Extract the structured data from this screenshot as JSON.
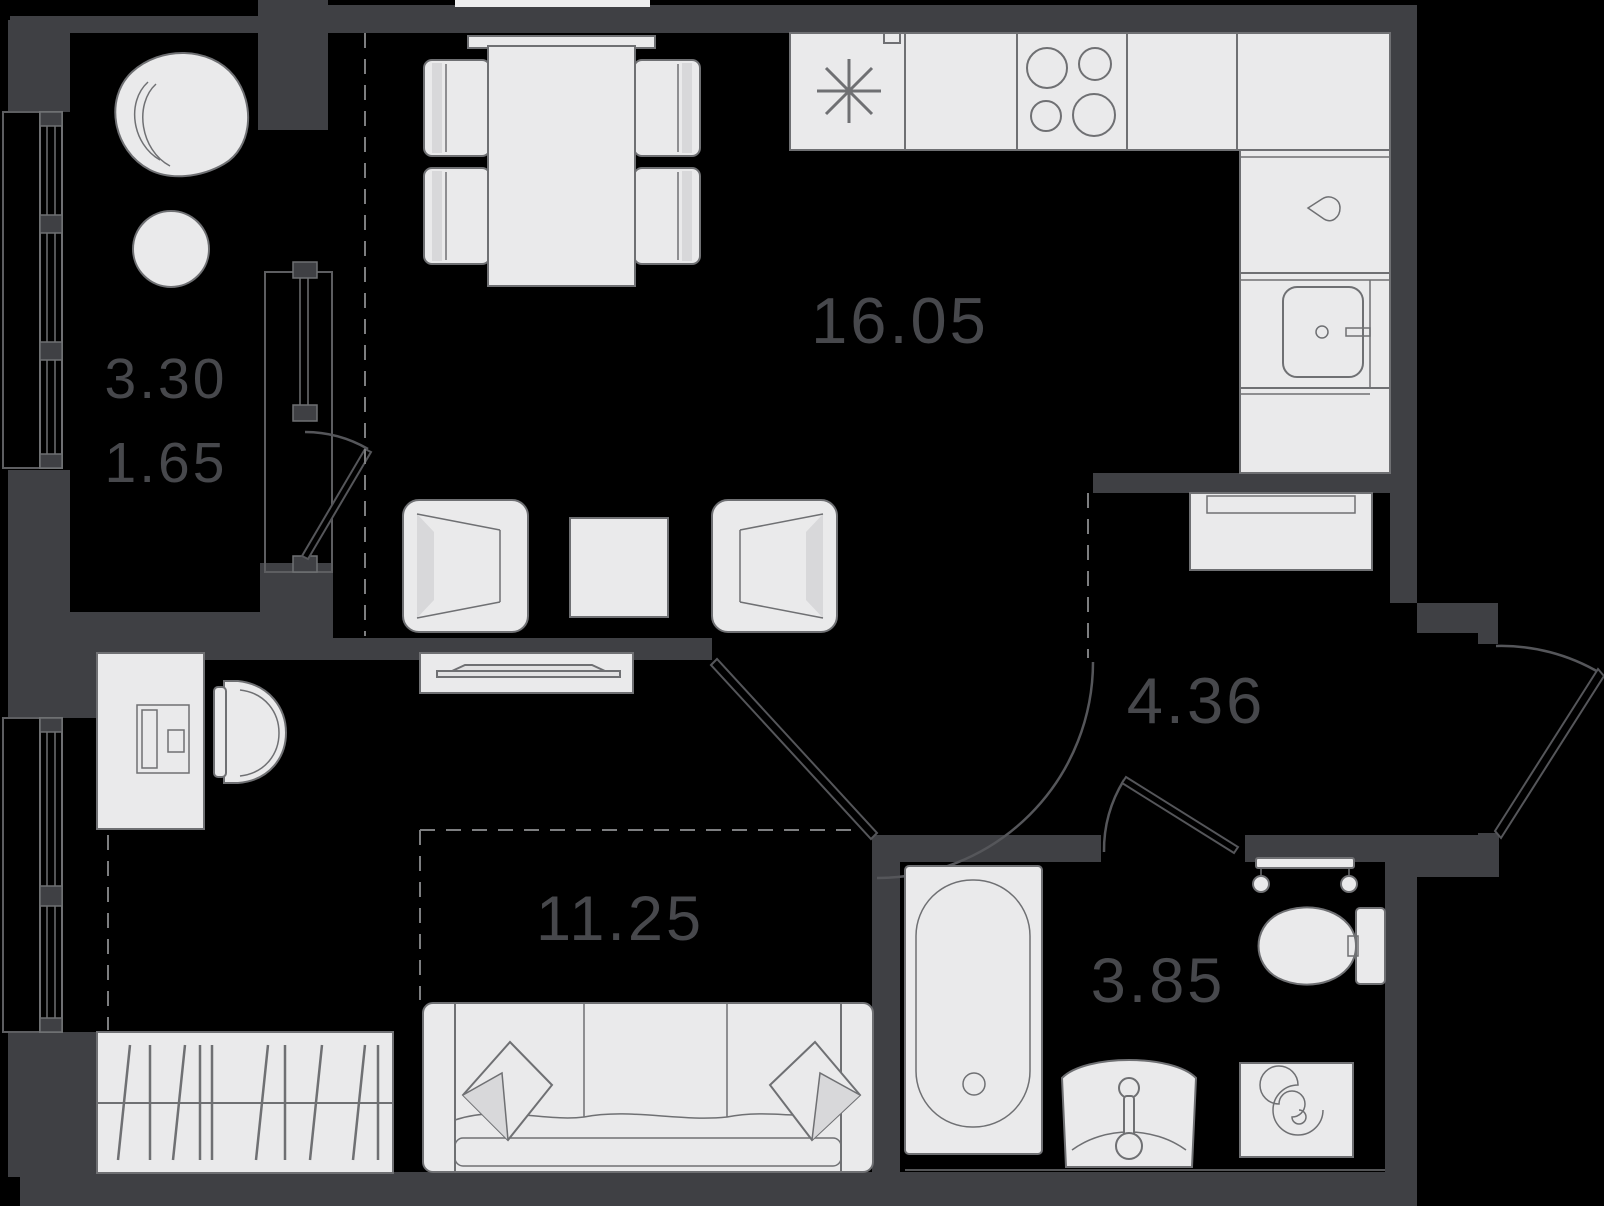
{
  "plan": {
    "title": "One-room apartment floor plan",
    "colors": {
      "background": "#000000",
      "walls": "#3f4044",
      "furniture_fill": "#eaeaeb",
      "furniture_stroke": "#6f7073",
      "label_text": "#47484c",
      "dashed_zone_line": "#7d7e80"
    },
    "rooms": [
      {
        "name": "balcony",
        "label_primary": "3.30",
        "label_secondary": "1.65",
        "furniture": [
          "lounge-chair",
          "round-table",
          "panoramic-window"
        ]
      },
      {
        "name": "living-kitchen",
        "label": "16.05",
        "furniture": [
          "dining-table",
          "dining-chair",
          "dining-chair",
          "dining-chair",
          "dining-chair",
          "window-sill",
          "fridge",
          "countertop",
          "hob-4-burners",
          "kitchen-sink",
          "armchair",
          "armchair",
          "coffee-table",
          "tv-stand",
          "balcony-door"
        ]
      },
      {
        "name": "hallway",
        "label": "4.36",
        "furniture": [
          "built-in-closet",
          "entrance-door"
        ]
      },
      {
        "name": "bedroom",
        "label": "11.25",
        "furniture": [
          "desk",
          "computer",
          "desk-chair",
          "wardrobe",
          "sofa",
          "pillow",
          "pillow",
          "window"
        ]
      },
      {
        "name": "bathroom",
        "label": "3.85",
        "furniture": [
          "bathtub",
          "washbasin",
          "faucet",
          "toilet",
          "towel-rail",
          "washing-machine"
        ]
      }
    ]
  }
}
